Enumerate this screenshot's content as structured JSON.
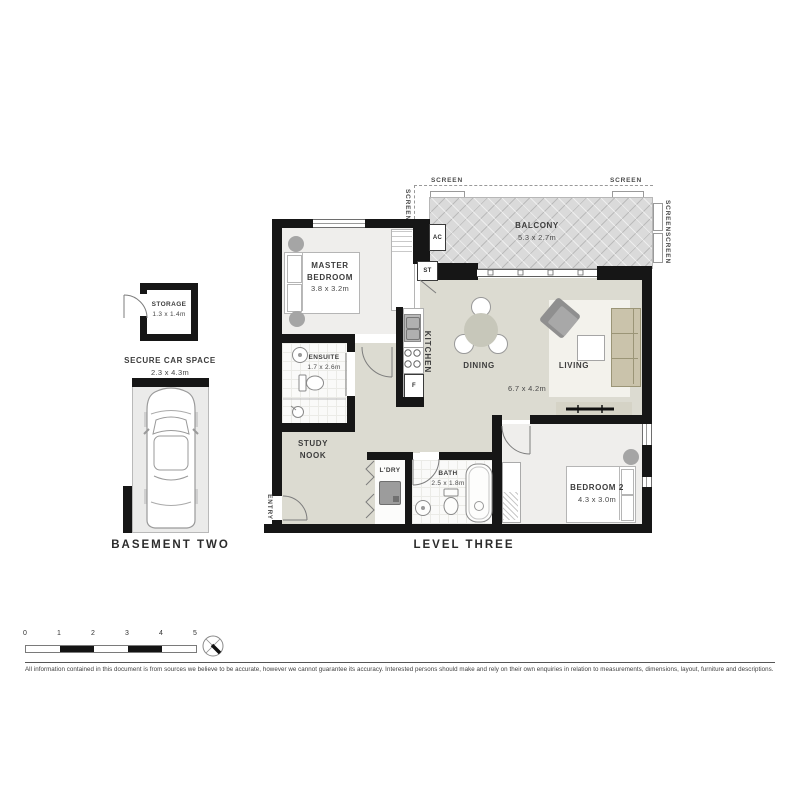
{
  "plan": {
    "level_label": "LEVEL THREE",
    "basement_label": "BASEMENT TWO",
    "balcony": {
      "name": "BALCONY",
      "dims": "5.3 x 2.7m"
    },
    "screen_label": "SCREEN",
    "master": {
      "name": "MASTER BEDROOM",
      "dims": "3.8 x 3.2m"
    },
    "ensuite": {
      "name": "ENSUITE",
      "dims": "1.7 x 2.6m"
    },
    "kitchen_label": "KITCHEN",
    "dining_label": "DINING",
    "living_label": "LIVING",
    "living_dims": "6.7 x 4.2m",
    "study_label": "STUDY NOOK",
    "laundry_label": "L'DRY",
    "bath": {
      "name": "BATH",
      "dims": "2.5 x 1.8m"
    },
    "bedroom2": {
      "name": "BEDROOM 2",
      "dims": "4.3 x 3.0m"
    },
    "entry_label": "ENTRY",
    "ac_label": "AC",
    "st_label": "ST",
    "fridge_label": "F",
    "storage": {
      "name": "STORAGE",
      "dims": "1.3 x 1.4m"
    },
    "car_space": {
      "name": "SECURE CAR SPACE",
      "dims": "2.3 x 4.3m"
    }
  },
  "scale_bar": {
    "ticks": [
      "0",
      "1",
      "2",
      "3",
      "4",
      "5"
    ]
  },
  "disclaimer": "All information contained in this document is from sources we believe to be accurate, however we cannot guarantee its accuracy. Interested persons should make and rely on their own enquiries in relation to measurements, dimensions, layout, furniture and descriptions.",
  "colors": {
    "wall": "#161616",
    "open_floor": "#dcdbd1",
    "bedroom_floor": "#efeeec",
    "balcony_floor": "#dadada",
    "sofa": "#cac3ab",
    "furniture_grey": "#a5a5a5"
  }
}
